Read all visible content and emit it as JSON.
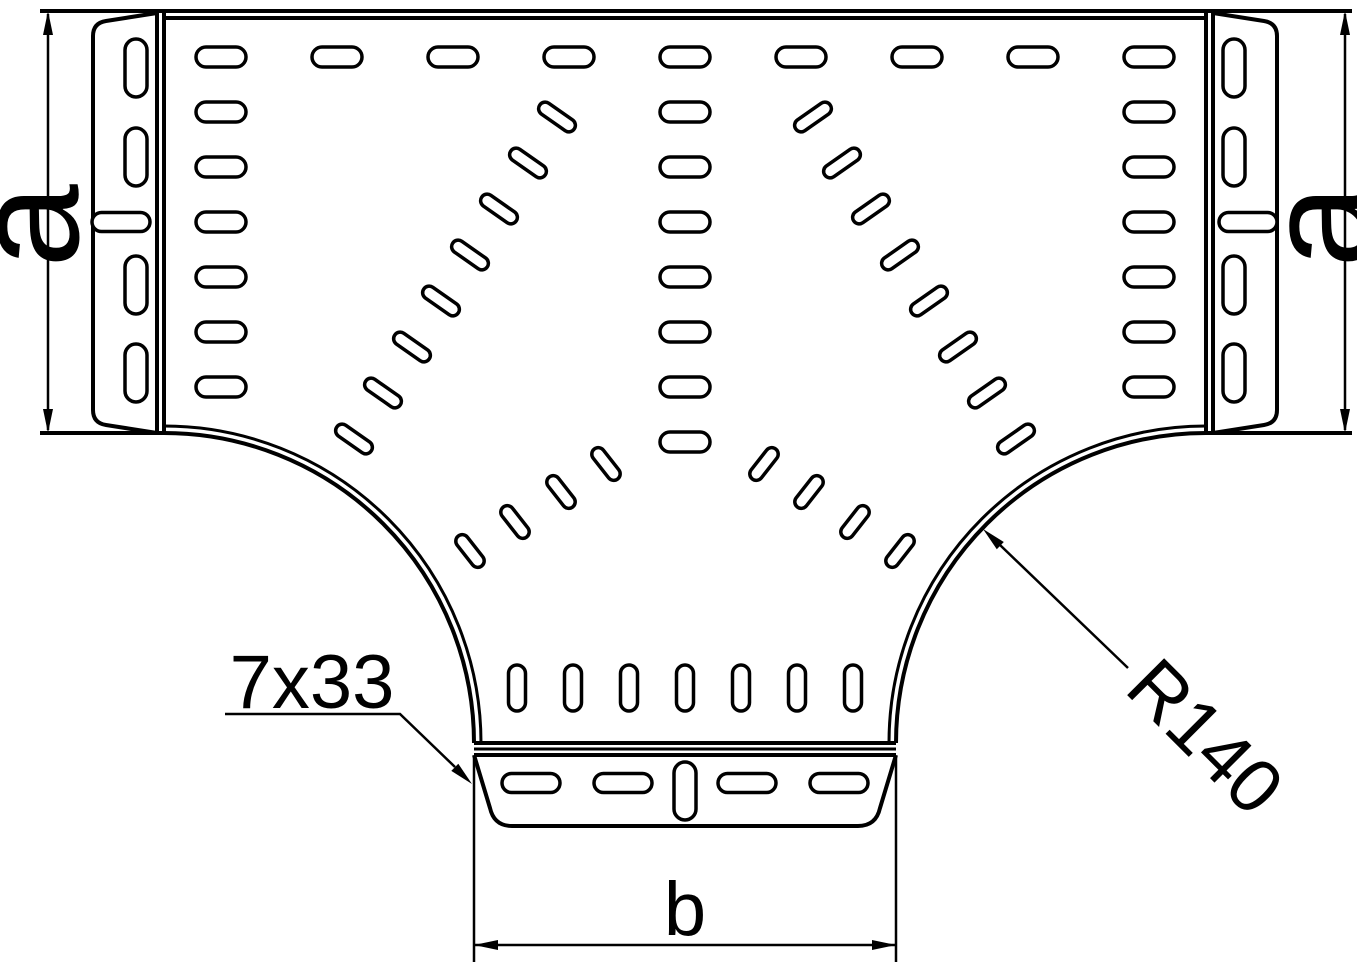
{
  "page": {
    "background": "#ffffff",
    "line_color": "#000000",
    "description": "Technical drawing: perforated cable tray T-piece (tee section), top view, with dimension callouts"
  },
  "labels": {
    "dim_a_left": "a",
    "dim_a_right": "a",
    "dim_b": "b",
    "slot_callout": "7x33",
    "radius_callout": "R140"
  },
  "drawing": {
    "stroke_main": 4,
    "stroke_slot": 3.5,
    "stroke_dim": 2.5,
    "paths": [
      {
        "name": "top-edge-outer",
        "d": "M40,11 H1352",
        "sw": 4
      },
      {
        "name": "top-edge-inner",
        "d": "M164,18 H1206",
        "sw": 4
      },
      {
        "name": "bottom-edge-left",
        "d": "M40,433 H164",
        "sw": 4
      },
      {
        "name": "bottom-edge-right",
        "d": "M1206,433 H1352",
        "sw": 4
      },
      {
        "name": "left-joint-line-1",
        "d": "M157,11 V433",
        "sw": 4
      },
      {
        "name": "left-joint-line-2",
        "d": "M164,11 V433",
        "sw": 4
      },
      {
        "name": "right-joint-line-1",
        "d": "M1206,11 V433",
        "sw": 4
      },
      {
        "name": "right-joint-line-2",
        "d": "M1213,11 V433",
        "sw": 4
      },
      {
        "name": "left-flange-plate",
        "d": "M157,13 L106,21 Q93,23 93,36 L93,410 Q93,423 106,425 L157,433",
        "sw": 4
      },
      {
        "name": "right-flange-plate",
        "d": "M1213,13 L1264,21 Q1277,23 1277,36 L1277,410 Q1277,423 1264,425 L1213,433",
        "sw": 4
      },
      {
        "name": "left-bend-outer",
        "d": "M164,433 A310,310 0 0 1 474,743",
        "sw": 4
      },
      {
        "name": "left-bend-inner",
        "d": "M164,426 A317,317 0 0 1 481,743",
        "sw": 3
      },
      {
        "name": "right-bend-outer",
        "d": "M1206,433 A310,310 0 0 0 896,743",
        "sw": 4
      },
      {
        "name": "right-bend-inner",
        "d": "M1206,426 A317,317 0 0 0 889,743",
        "sw": 3
      },
      {
        "name": "branch-joint-line-1",
        "d": "M474,743 H896",
        "sw": 4
      },
      {
        "name": "branch-joint-line-2",
        "d": "M474,749 H896",
        "sw": 3
      },
      {
        "name": "bottom-flange-top-edge",
        "d": "M474,755 H896",
        "sw": 4
      },
      {
        "name": "bottom-flange-plate",
        "d": "M474,755 L490,808 Q494,826 512,826 L858,826 Q876,826 880,808 L896,755",
        "sw": 4
      },
      {
        "name": "dim-a-left-line",
        "d": "M48,14 V430",
        "sw": 2.5
      },
      {
        "name": "dim-a-right-line",
        "d": "M1345,14 V430",
        "sw": 2.5
      },
      {
        "name": "dim-b-ext-left",
        "d": "M474,757 V962",
        "sw": 2.5
      },
      {
        "name": "dim-b-ext-right",
        "d": "M896,757 V962",
        "sw": 2.5
      },
      {
        "name": "dim-b-line",
        "d": "M474,945 H896",
        "sw": 2.5
      },
      {
        "name": "callout-7x33-leader",
        "d": "M225,714 H400 L455,767",
        "sw": 2.5
      },
      {
        "name": "callout-r140-leader",
        "d": "M1128,668 L1000,545",
        "sw": 2.5
      }
    ],
    "arrowheads": [
      {
        "name": "dim-a-left-arrow-top",
        "points": "48,11 43,35 53,35"
      },
      {
        "name": "dim-a-left-arrow-bottom",
        "points": "48,433 43,409 53,409"
      },
      {
        "name": "dim-a-right-arrow-top",
        "points": "1345,11 1340,35 1350,35"
      },
      {
        "name": "dim-a-right-arrow-bottom",
        "points": "1345,433 1340,409 1350,409"
      },
      {
        "name": "dim-b-arrow-left",
        "points": "474,945 498,940 498,950"
      },
      {
        "name": "dim-b-arrow-right",
        "points": "896,945 872,940 872,950"
      },
      {
        "name": "callout-7x33-arrow",
        "points": "472,784 458.3,763.7 451.3,770.9"
      },
      {
        "name": "callout-r140-arrow",
        "points": "983,529 1003.8,542 996.8,549.2"
      }
    ],
    "slot_sizes": {
      "h": {
        "w": 50,
        "h": 20
      },
      "hf": {
        "w": 58,
        "h": 19
      },
      "vf": {
        "w": 22,
        "h": 58
      },
      "v33": {
        "w": 17,
        "h": 46
      },
      "d": {
        "w": 42,
        "h": 13
      },
      "f": {
        "w": 38,
        "h": 13
      }
    },
    "slot_groups": [
      {
        "name": "top-row-slots",
        "size": "h",
        "angle": 0,
        "slots": [
          [
            221,
            57
          ],
          [
            337,
            57
          ],
          [
            453,
            57
          ],
          [
            569,
            57
          ],
          [
            685,
            57
          ],
          [
            801,
            57
          ],
          [
            917,
            57
          ],
          [
            1033,
            57
          ],
          [
            1149,
            57
          ]
        ]
      },
      {
        "name": "left-column-slots",
        "size": "h",
        "angle": 0,
        "slots": [
          [
            221,
            112
          ],
          [
            221,
            167
          ],
          [
            221,
            222
          ],
          [
            221,
            277
          ],
          [
            221,
            332
          ],
          [
            221,
            387
          ]
        ]
      },
      {
        "name": "right-column-slots",
        "size": "h",
        "angle": 0,
        "slots": [
          [
            1149,
            112
          ],
          [
            1149,
            167
          ],
          [
            1149,
            222
          ],
          [
            1149,
            277
          ],
          [
            1149,
            332
          ],
          [
            1149,
            387
          ]
        ]
      },
      {
        "name": "center-column-slots",
        "size": "h",
        "angle": 0,
        "slots": [
          [
            685,
            112
          ],
          [
            685,
            167
          ],
          [
            685,
            222
          ],
          [
            685,
            277
          ],
          [
            685,
            332
          ],
          [
            685,
            387
          ],
          [
            685,
            442
          ]
        ]
      },
      {
        "name": "left-diagonal-slots",
        "size": "d",
        "angle": 35,
        "slots": [
          [
            557,
            117
          ],
          [
            528,
            163
          ],
          [
            499,
            209
          ],
          [
            470,
            255
          ],
          [
            441,
            301
          ],
          [
            412,
            347
          ],
          [
            383,
            393
          ],
          [
            354,
            439
          ]
        ]
      },
      {
        "name": "right-diagonal-slots",
        "size": "d",
        "angle": -35,
        "slots": [
          [
            813,
            117
          ],
          [
            842,
            163
          ],
          [
            871,
            209
          ],
          [
            900,
            255
          ],
          [
            929,
            301
          ],
          [
            958,
            347
          ],
          [
            987,
            393
          ],
          [
            1016,
            439
          ]
        ]
      },
      {
        "name": "left-fan-slots",
        "size": "f",
        "angle": 52,
        "slots": [
          [
            606,
            464
          ],
          [
            561,
            492
          ],
          [
            515,
            522
          ],
          [
            470,
            551
          ]
        ]
      },
      {
        "name": "right-fan-slots",
        "size": "f",
        "angle": -52,
        "slots": [
          [
            764,
            464
          ],
          [
            809,
            492
          ],
          [
            855,
            522
          ],
          [
            900,
            551
          ]
        ]
      },
      {
        "name": "branch-vertical-slots",
        "size": "v33",
        "angle": 0,
        "slots": [
          [
            517,
            688
          ],
          [
            573,
            688
          ],
          [
            629,
            688
          ],
          [
            685,
            688
          ],
          [
            741,
            688
          ],
          [
            797,
            688
          ],
          [
            853,
            688
          ]
        ]
      },
      {
        "name": "left-flange-vertical-slots",
        "size": "vf",
        "angle": 0,
        "slots": [
          [
            136,
            68
          ],
          [
            136,
            157
          ],
          [
            136,
            285
          ],
          [
            136,
            373
          ]
        ]
      },
      {
        "name": "right-flange-vertical-slots",
        "size": "vf",
        "angle": 0,
        "slots": [
          [
            1234,
            68
          ],
          [
            1234,
            157
          ],
          [
            1234,
            285
          ],
          [
            1234,
            373
          ]
        ]
      },
      {
        "name": "left-flange-horizontal-slot",
        "size": "hf",
        "angle": 0,
        "slots": [
          [
            121,
            222
          ]
        ]
      },
      {
        "name": "right-flange-horizontal-slot",
        "size": "hf",
        "angle": 0,
        "slots": [
          [
            1248,
            222
          ]
        ]
      },
      {
        "name": "bottom-flange-horizontal-slots",
        "size": "hf",
        "angle": 0,
        "slots": [
          [
            531,
            783
          ],
          [
            623,
            783
          ],
          [
            747,
            783
          ],
          [
            839,
            783
          ]
        ]
      },
      {
        "name": "bottom-flange-vertical-slot",
        "size": "vf",
        "angle": 0,
        "slots": [
          [
            685,
            791
          ]
        ]
      }
    ]
  }
}
